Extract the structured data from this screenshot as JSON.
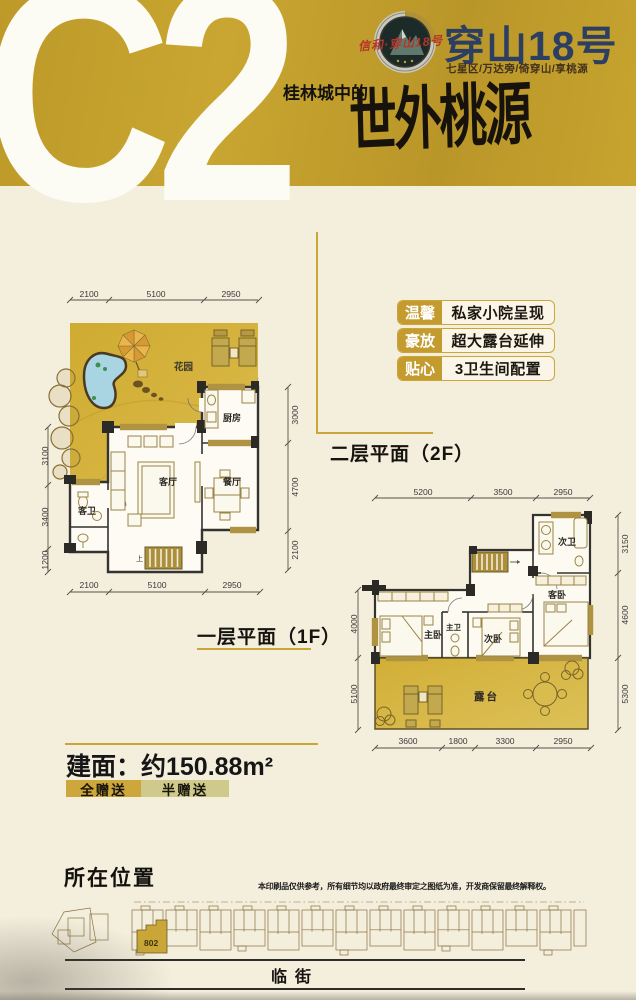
{
  "header": {
    "unit_code": "C2",
    "brand": "穿山18号",
    "brand_seal": "信和·穿山18号",
    "tagline": "七星区/万达旁/倚穿山/享桃源",
    "slogan_prefix": "桂林城中的",
    "slogan_main": "世外桃源",
    "gold_color": "#c4a12d",
    "brand_color": "#2c3f63"
  },
  "features": [
    {
      "tag": "温馨",
      "text": "私家小院呈现"
    },
    {
      "tag": "豪放",
      "text": "超大露台延伸"
    },
    {
      "tag": "贴心",
      "text": "3卫生间配置"
    }
  ],
  "plan_1f": {
    "title": "一层平面（1F）",
    "rooms": {
      "garden": "花园",
      "kitchen": "厨房",
      "living": "客厅",
      "dining": "餐厅",
      "guest_bath": "客卫",
      "stairs": "上"
    },
    "dims_top": [
      "2100",
      "5100",
      "2950"
    ],
    "dims_bottom": [
      "2100",
      "5100",
      "2950"
    ],
    "dims_left": [
      "3100",
      "3400",
      "1200"
    ],
    "dims_right": [
      "3000",
      "4700",
      "2100"
    ]
  },
  "plan_2f": {
    "title": "二层平面（2F）",
    "rooms": {
      "master": "主卧",
      "master_bath": "主卫",
      "second": "次卧",
      "guest": "客卧",
      "second_bath": "次卫",
      "terrace": "露台"
    },
    "dims_top": [
      "5200",
      "3500",
      "2950"
    ],
    "dims_bottom": [
      "3600",
      "1800",
      "3300",
      "2950"
    ],
    "dims_left": [
      "4000",
      "5100"
    ],
    "dims_right": [
      "3150",
      "4600",
      "5300"
    ]
  },
  "area": {
    "label": "建面：约150.88m²"
  },
  "legend": [
    {
      "label": "全赠送",
      "color": "#cda63c"
    },
    {
      "label": "半赠送",
      "color": "#cfc98b"
    }
  ],
  "location": {
    "title": "所在位置",
    "disclaimer": "本印刷品仅供参考，所有细节均以政府最终审定之图纸为准，开发商保留最终解释权。",
    "unit_label": "802",
    "street_label": "临街"
  }
}
